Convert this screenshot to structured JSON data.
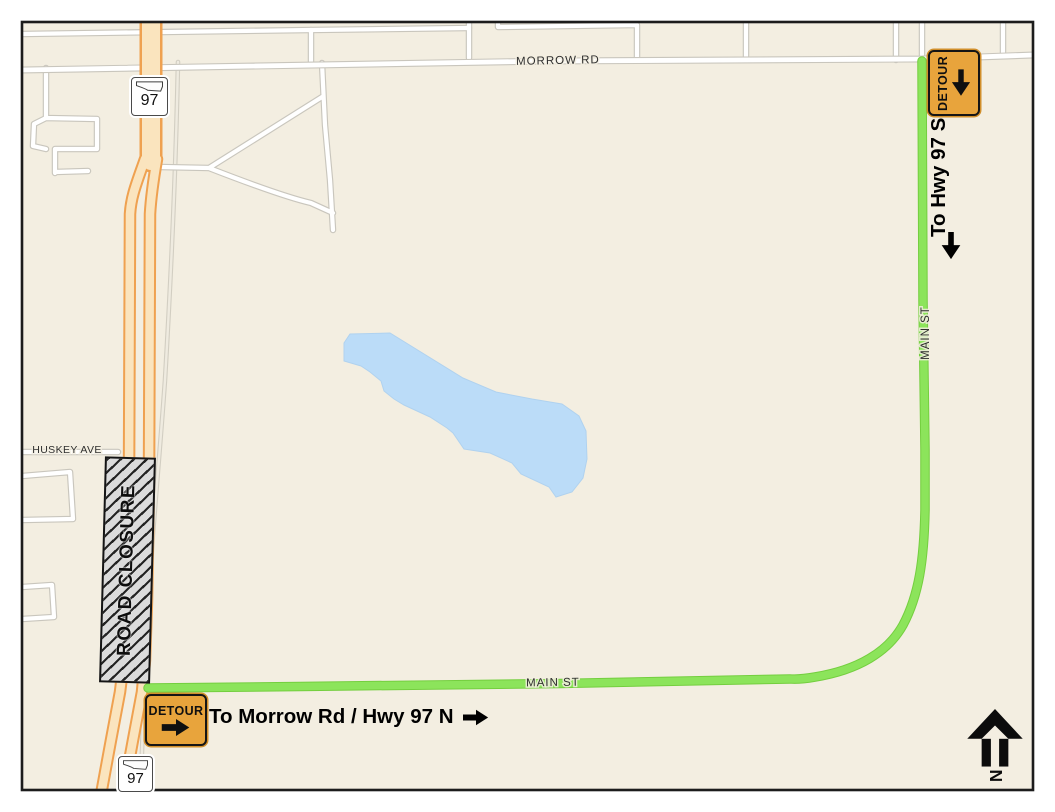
{
  "map": {
    "roads": {
      "morrow_label": "MORROW RD",
      "main_st_vertical_label": "MAIN ST",
      "main_st_horizontal_label": "MAIN ST",
      "huskey_label": "HUSKEY AVE"
    },
    "closure_label": "ROAD CLOSURE",
    "detour_sign_top_label": "DETOUR",
    "detour_sign_bottom_label": "DETOUR",
    "direction_south_label": "To Hwy 97 S",
    "direction_north_label": "To Morrow Rd / Hwy 97 N",
    "shield_top": "97",
    "shield_bottom": "97",
    "north_indicator_label": "N",
    "colors": {
      "background": "#F3EEE1",
      "detour_route_green": "#8CE45B",
      "highway_fill": "#FAE4BE",
      "highway_casing": "#EFA150",
      "lake_blue": "#BBDCF8",
      "sign_orange": "#E8A43C",
      "closure_gray": "#DBDBDB"
    }
  }
}
